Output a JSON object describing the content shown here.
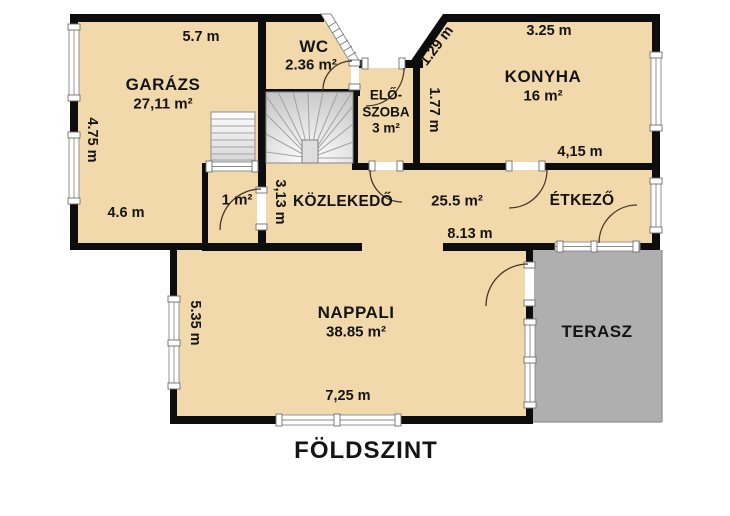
{
  "title": "FÖLDSZINT",
  "rooms": {
    "garage": {
      "name": "GARÁZS",
      "area": "27,11 m²"
    },
    "wc": {
      "name": "WC",
      "area": "2.36 m²"
    },
    "entry_hall": {
      "name_line1": "ELŐ-",
      "name_line2": "SZOBA",
      "area": "3 m²"
    },
    "kitchen": {
      "name": "KONYHA",
      "area": "16 m²"
    },
    "corridor": {
      "name": "KÖZLEKEDŐ",
      "area": "25.5 m²"
    },
    "dining": {
      "name": "ÉTKEZŐ"
    },
    "living": {
      "name": "NAPPALI",
      "area": "38.85 m²"
    },
    "storage": {
      "area": "1 m²"
    },
    "terrace": {
      "name": "TERASZ"
    }
  },
  "dimensions": {
    "garage_width": "5.7 m",
    "garage_height": "4.75 m",
    "garage_bottom": "4.6 m",
    "entry_angle": "1.29 m",
    "kitchen_width": "3.25 m",
    "kitchen_left": "1.77 m",
    "kitchen_bottom": "4,15 m",
    "corridor_height": "3,13 m",
    "corridor_width": "8.13 m",
    "living_width": "7,25 m",
    "living_height": "5.35 m"
  },
  "colors": {
    "room_fill": "#f2d9ab",
    "wall": "#0d0d0d",
    "terrace_fill": "#afafaf",
    "door_arc": "#463726",
    "background": "#ffffff"
  }
}
